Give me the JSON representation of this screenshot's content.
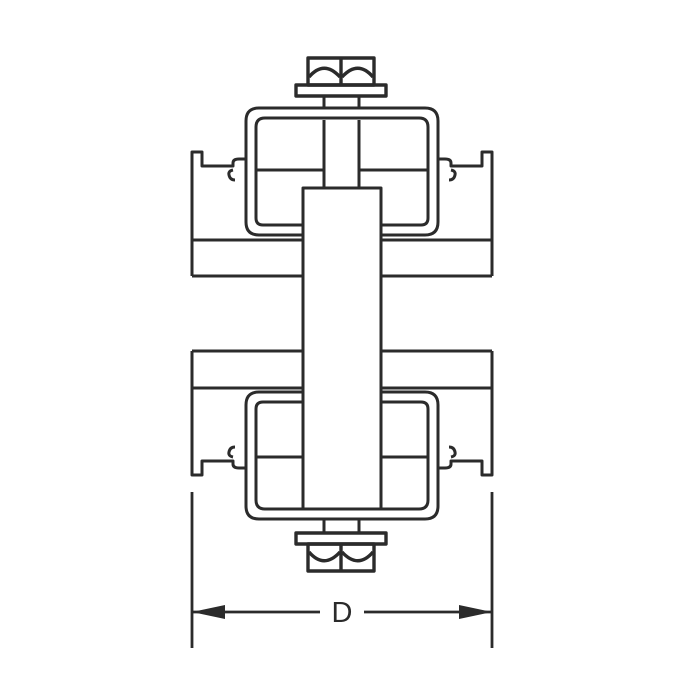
{
  "figure": {
    "type": "technical-line-drawing",
    "description": "Cross-section drawing of a double strut-channel clamp assembly: two opposed strut channels separated by a center spacer block, secured by top and bottom U-clamp brackets, each tightened with a hex bolt and washer",
    "background_color": "#ffffff",
    "line_color": "#2b2b2b",
    "dimension": {
      "label": "D",
      "style": "double-headed arrow between extension lines across overall width"
    },
    "parts": [
      "top-hex-bolt",
      "top-washer",
      "top-clamp-bracket",
      "upper-strut-channel",
      "spacer-block",
      "lower-strut-channel",
      "bottom-clamp-bracket",
      "bottom-washer",
      "bottom-hex-bolt",
      "width-dimension-D"
    ]
  }
}
